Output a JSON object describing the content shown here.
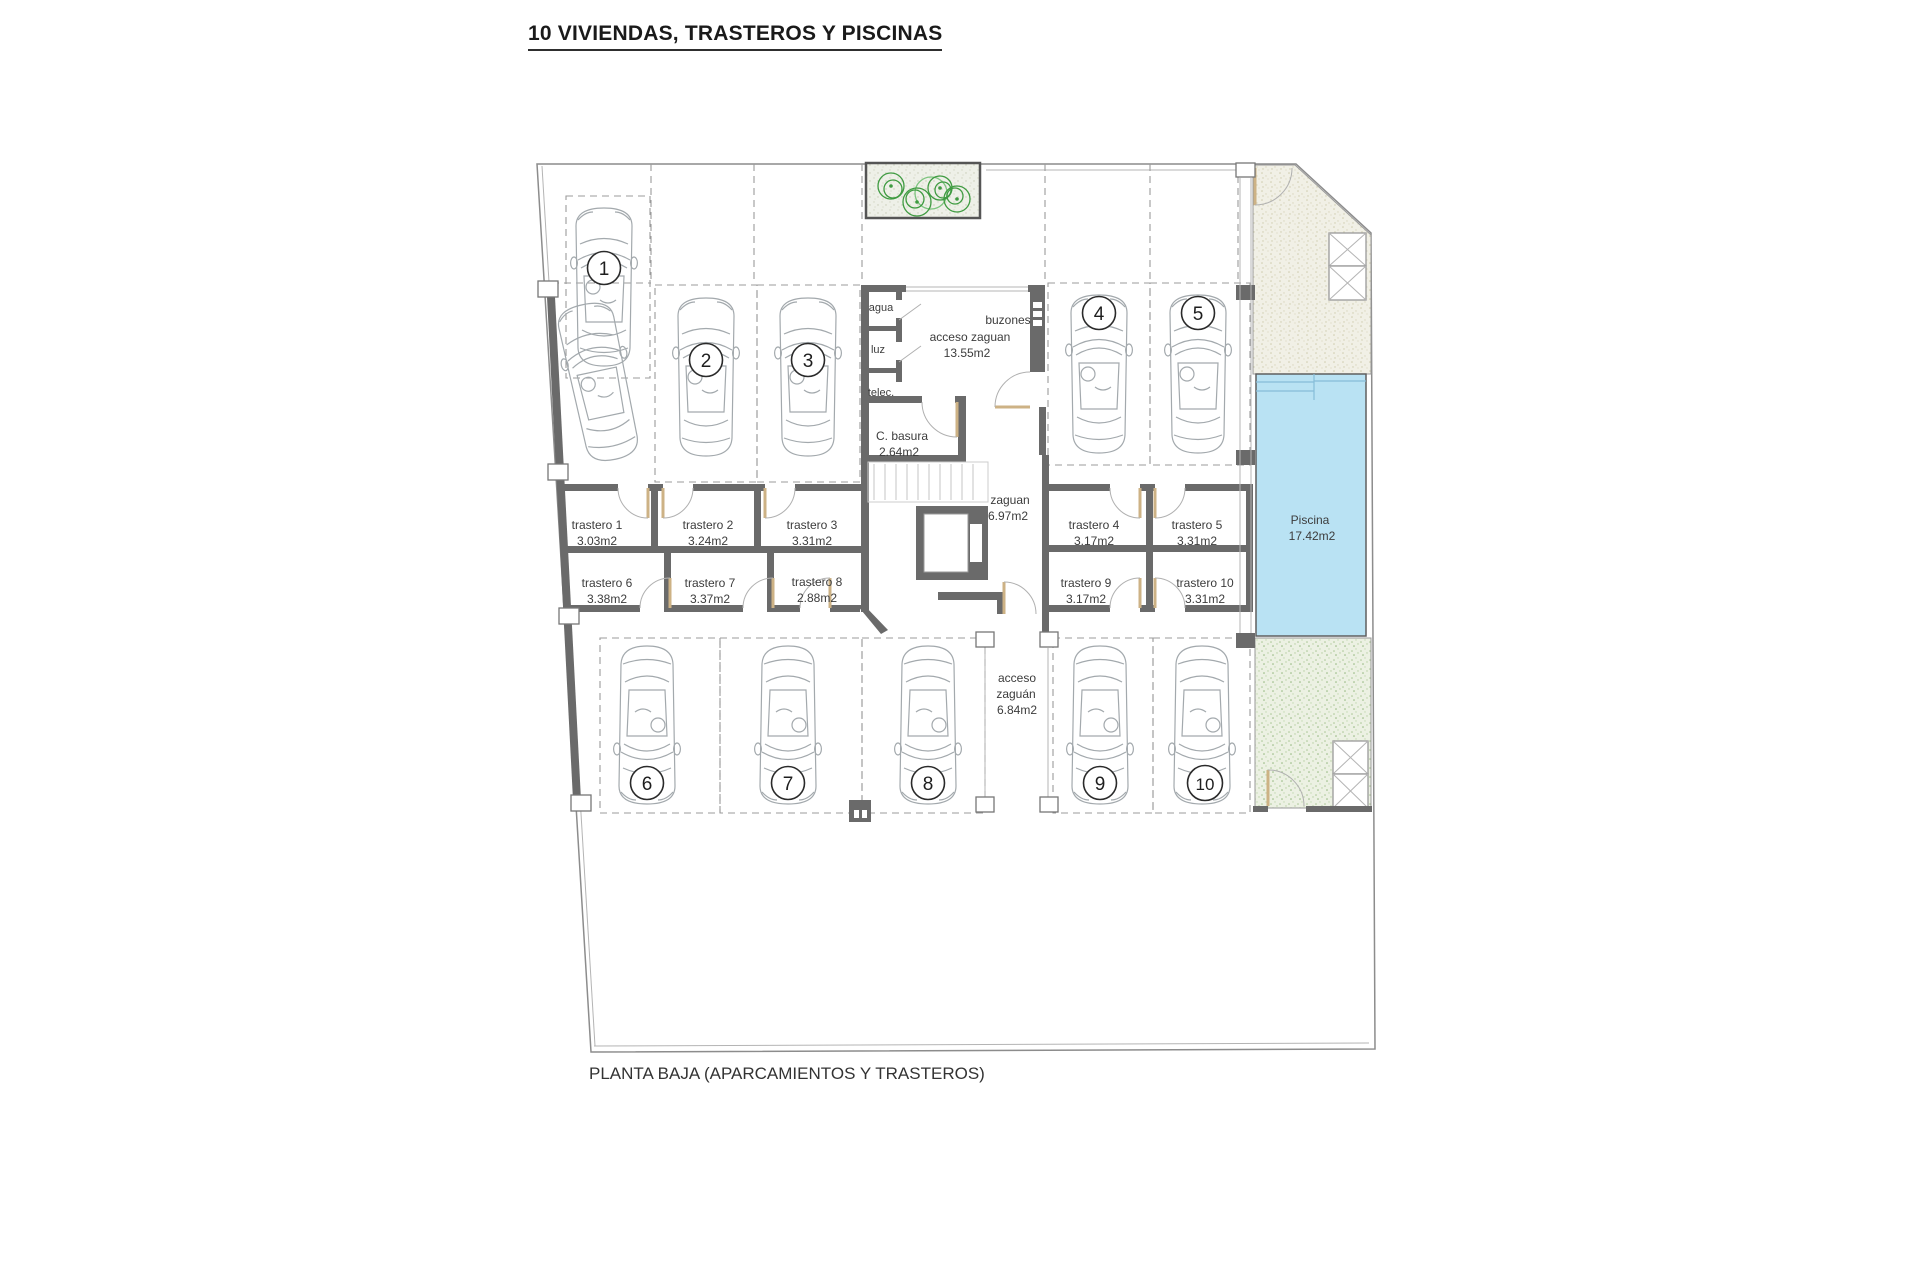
{
  "title": "10 VIVIENDAS, TRASTEROS Y PISCINAS",
  "footer": "PLANTA BAJA (APARCAMIENTOS Y TRASTEROS)",
  "colors": {
    "wall": "#6a6a6a",
    "pool": "#b9e2f3",
    "dashed_line": "#9b9b9b",
    "door_leaf": "#cdb285",
    "tree": "#3f9b41"
  },
  "parking_spaces": [
    {
      "num": "1"
    },
    {
      "num": "2"
    },
    {
      "num": "3"
    },
    {
      "num": "4"
    },
    {
      "num": "5"
    },
    {
      "num": "6"
    },
    {
      "num": "7"
    },
    {
      "num": "8"
    },
    {
      "num": "9"
    },
    {
      "num": "10"
    }
  ],
  "trasteros": [
    {
      "name": "trastero 1",
      "area": "3.03m2"
    },
    {
      "name": "trastero 2",
      "area": "3.24m2"
    },
    {
      "name": "trastero 3",
      "area": "3.31m2"
    },
    {
      "name": "trastero 4",
      "area": "3.17m2"
    },
    {
      "name": "trastero 5",
      "area": "3.31m2"
    },
    {
      "name": "trastero 6",
      "area": "3.38m2"
    },
    {
      "name": "trastero 7",
      "area": "3.37m2"
    },
    {
      "name": "trastero 8",
      "area": "2.88m2"
    },
    {
      "name": "trastero 9",
      "area": "3.17m2"
    },
    {
      "name": "trastero 10",
      "area": "3.31m2"
    }
  ],
  "rooms": {
    "agua": "agua",
    "luz": "luz",
    "telec": "telec.",
    "buzones": "buzones",
    "acceso_zaguan": {
      "name": "acceso zaguan",
      "area": "13.55m2"
    },
    "c_basura": {
      "name": "C. basura",
      "area": "2.64m2"
    },
    "zaguan": {
      "name": "zaguan",
      "area": "6.97m2"
    },
    "acceso_zaguan_bajo": {
      "line1": "acceso",
      "line2": "zaguán",
      "area": "6.84m2"
    },
    "piscina": {
      "name": "Piscina",
      "area": "17.42m2"
    }
  }
}
